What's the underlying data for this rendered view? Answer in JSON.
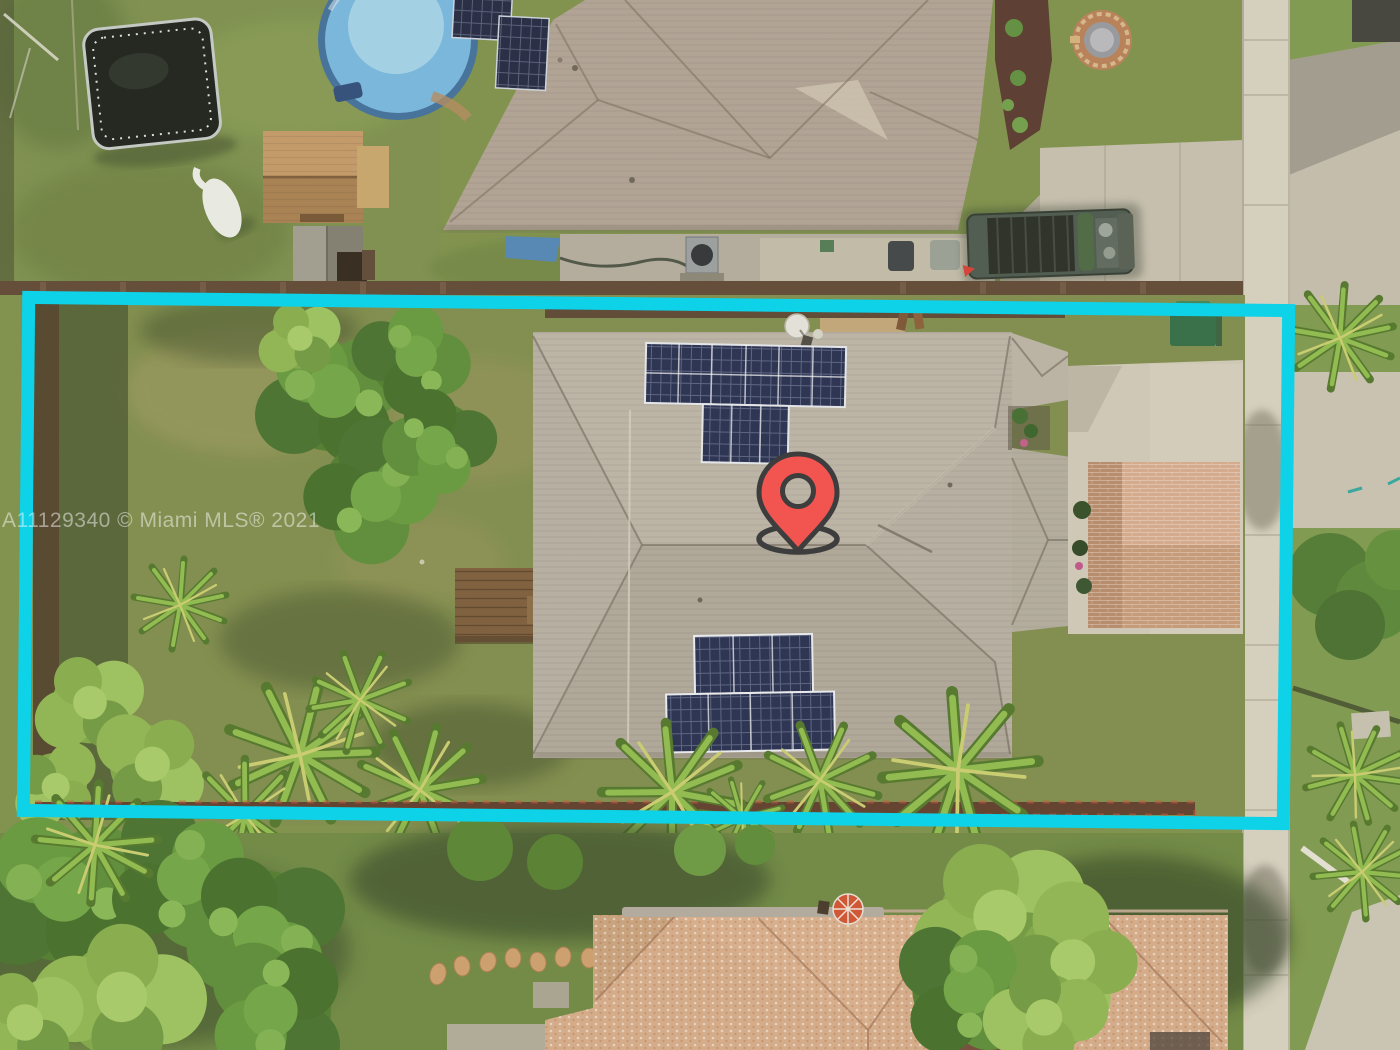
{
  "watermark": {
    "text": "A11129340 © Miami MLS® 2021",
    "color": "#ffffff"
  },
  "overlays": {
    "property_boundary": {
      "shape": "rectangle",
      "color": "#0ed2e8"
    },
    "location_pin": {
      "fill": "#f2544f",
      "stroke": "#3d3d3d"
    }
  },
  "scene": {
    "type": "aerial-drone-photo",
    "visible_features": [
      "trampoline",
      "above-ground-pool",
      "storage-sheds",
      "neighbor-house-gray-roof",
      "rooftop-solar-panels",
      "pickup-truck",
      "concrete-driveway",
      "public-sidewalk",
      "subject-house-gray-hip-roof",
      "solar-array-front",
      "solar-array-back",
      "brick-paver-pad",
      "green-utility-box",
      "backyard-trees",
      "palm-trees",
      "wood-fence",
      "stepping-stones",
      "bottom-neighbor-tan-roof",
      "patio-umbrella"
    ]
  }
}
